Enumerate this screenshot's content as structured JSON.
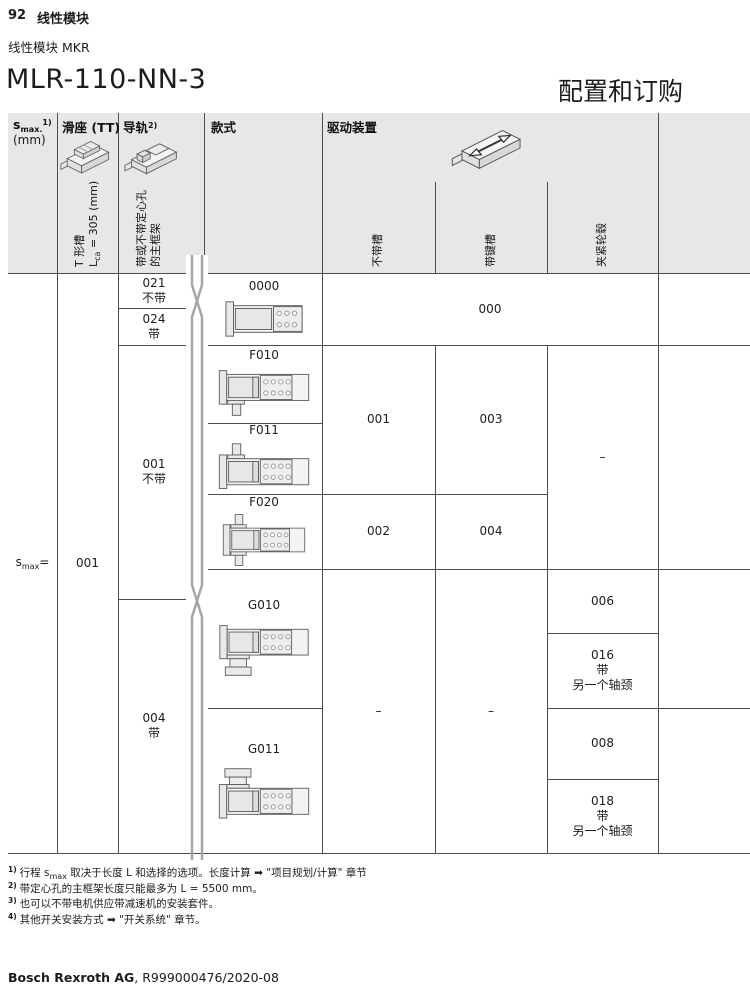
{
  "page": {
    "page_number": "92",
    "chapter": "线性模块",
    "subtitle": "线性模块 MKR",
    "title": "MLR-110-NN-3",
    "title_right": "配置和订购",
    "footer": {
      "company": "Bosch Rexroth AG",
      "doc_ref": ", R999000476/2020-08"
    }
  },
  "table": {
    "header": {
      "smax": {
        "base": "s",
        "sub": "max.",
        "sup": "1)",
        "unit": "(mm)"
      },
      "slide": {
        "title": "滑座 (TT)",
        "v1": "T 形槽",
        "v2_base": "L",
        "v2_sub": "ca",
        "v2_rest": " = 305 (mm)"
      },
      "rail": {
        "title": "导轨",
        "sup": "2)",
        "v1": "带或不带定心孔",
        "v2": "的主框架"
      },
      "style": {
        "title": "款式"
      },
      "drive": {
        "title": "驱动装置",
        "sub_no_groove": "不带槽",
        "sub_keyway": "带键槽",
        "sub_clamp_hub": "夹紧轮毂"
      }
    },
    "body": {
      "smax_eq": {
        "base": "s",
        "sub": "max",
        "eq": "="
      },
      "slide_code": "001",
      "rail_options": [
        {
          "code": "021",
          "note": "不带"
        },
        {
          "code": "024",
          "note": "带"
        },
        {
          "code": "001",
          "note": "不带"
        },
        {
          "code": "004",
          "note": "带"
        }
      ],
      "models": [
        {
          "code": "0000"
        },
        {
          "code": "F010"
        },
        {
          "code": "F011"
        },
        {
          "code": "F020"
        },
        {
          "code": "G010"
        },
        {
          "code": "G011"
        }
      ],
      "drive": {
        "all_000": "000",
        "f01x_no_groove": "001",
        "f01x_keyway": "003",
        "f020_no_groove": "002",
        "f020_keyway": "004",
        "f_clamp_dash": "–",
        "g_no_groove_dash": "–",
        "g_keyway_dash": "–",
        "g010_clamp": "006",
        "g010_clamp_alt": {
          "code": "016",
          "l2": "带",
          "l3": "另一个轴颈"
        },
        "g011_clamp": "008",
        "g011_clamp_alt": {
          "code": "018",
          "l2": "带",
          "l3": "另一个轴颈"
        }
      }
    }
  },
  "footnotes": {
    "f1": {
      "sup": "1)",
      "t1": "行程 s",
      "sub": "max",
      "t2": " 取决于长度 L 和选择的选项。长度计算 ",
      "arrow": "➡",
      "t3": " \"项目规划/计算\" 章节"
    },
    "f2": {
      "sup": "2)",
      "t1": "带定心孔的主框架长度只能最多为 L = 5500 mm。"
    },
    "f3": {
      "sup": "3)",
      "t1": "也可以不带电机供应带减速机的安装套件。"
    },
    "f4": {
      "sup": "4)",
      "t1": "其他开关安装方式 ",
      "arrow": "➡",
      "t2": " \"开关系统\" 章节。"
    }
  },
  "colors": {
    "header_bg": "#e7e7e5",
    "grid_line": "#4d4d4d",
    "break_band": "#a6a6a6"
  }
}
